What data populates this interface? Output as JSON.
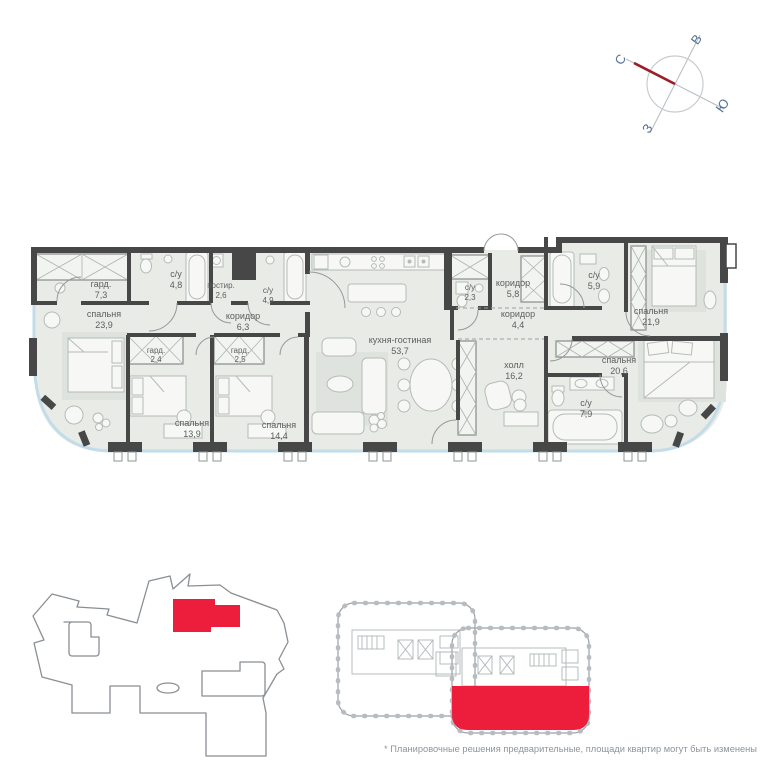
{
  "compass": {
    "n": "С",
    "e": "В",
    "s": "Ю",
    "w": "З"
  },
  "rooms": [
    {
      "name": "гард.",
      "area": "7,3"
    },
    {
      "name": "с/у",
      "area": "4,8"
    },
    {
      "name": "постир.",
      "area": "2,6"
    },
    {
      "name": "с/у",
      "area": "4,9"
    },
    {
      "name": "спальня",
      "area": "23,9"
    },
    {
      "name": "коридор",
      "area": "6,3"
    },
    {
      "name": "гард.",
      "area": "2,4"
    },
    {
      "name": "гард.",
      "area": "2,5"
    },
    {
      "name": "спальня",
      "area": "13,9"
    },
    {
      "name": "спальня",
      "area": "14,4"
    },
    {
      "name": "кухня-гостиная",
      "area": "53,7"
    },
    {
      "name": "с/у",
      "area": "2,3"
    },
    {
      "name": "коридор",
      "area": "5,8"
    },
    {
      "name": "с/у",
      "area": "5,9"
    },
    {
      "name": "коридор",
      "area": "4,4"
    },
    {
      "name": "спальня",
      "area": "21,9"
    },
    {
      "name": "спальня",
      "area": "20,6"
    },
    {
      "name": "холл",
      "area": "16,2"
    },
    {
      "name": "с/у",
      "area": "7,9"
    }
  ],
  "footer": {
    "disclaimer": "* Планировочные решения предварительные, площади квартир могут быть изменены"
  },
  "colors": {
    "accent_red": "#ec1e3c",
    "wall": "#474747",
    "floor": "#e9ebe7",
    "glass": "#c2dde9",
    "compass_needle": "#9c1c27"
  }
}
